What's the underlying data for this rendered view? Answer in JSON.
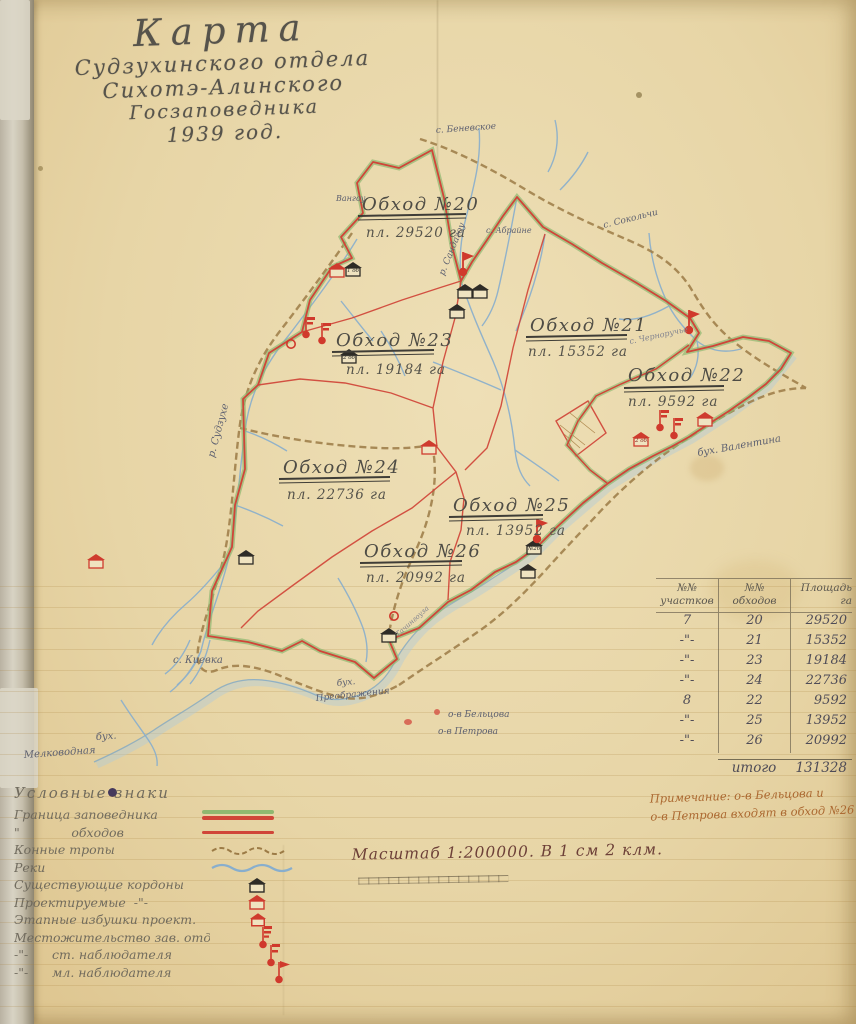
{
  "title": {
    "line1": "Карта",
    "line2": "Судзухинского отдела",
    "line3": "Сихотэ-Алинского",
    "line4": "Госзаповедника",
    "line5": "1939 год."
  },
  "map": {
    "obkhods": [
      {
        "name": "Обход №20",
        "area": "пл. 29520 га"
      },
      {
        "name": "Обход №21",
        "area": "пл. 15352 га"
      },
      {
        "name": "Обход №22",
        "area": "пл. 9592 га"
      },
      {
        "name": "Обход №23",
        "area": "пл. 19184 га"
      },
      {
        "name": "Обход №24",
        "area": "пл. 22736 га"
      },
      {
        "name": "Обход №25",
        "area": "пл. 13952 га"
      },
      {
        "name": "Обход №26",
        "area": "пл. 20992 га"
      }
    ],
    "places": {
      "benevskoe": "с. Беневское",
      "sokolchi": "с. Сокольчи",
      "chernoruchye": "с. Черноручье",
      "vangou": "Вангоу",
      "abrayne": "с. Абрайне",
      "sudzuhe": "р. Судзухе",
      "sandagou": "р. Сандагоу",
      "kievka": "с. Киевка",
      "preobrazheniya1": "бух.",
      "preobrazheniya2": "Преображения",
      "beltsova": "о-в Бельцова",
      "petrova": "о-в Петрова",
      "melkovodnaya1": "бух.",
      "melkovodnaya2": "Мелководная",
      "valentina": "бух. Валентина",
      "tachingouza": "Тачингоуза"
    },
    "house_labels": {
      "vangou": "1 об.",
      "kordon23": "2 об.",
      "coast26": "№26",
      "valentina": "2 об."
    }
  },
  "table": {
    "headers": [
      {
        "top": "№№",
        "bottom": "участков"
      },
      {
        "top": "№№",
        "bottom": "обходов"
      },
      {
        "top": "Площадь",
        "bottom": "га"
      }
    ],
    "rows": [
      [
        "7",
        "20",
        "29520"
      ],
      [
        "-\"-",
        "21",
        "15352"
      ],
      [
        "-\"-",
        "23",
        "19184"
      ],
      [
        "-\"-",
        "24",
        "22736"
      ],
      [
        "8",
        "22",
        "9592"
      ],
      [
        "-\"-",
        "25",
        "13952"
      ],
      [
        "-\"-",
        "26",
        "20992"
      ]
    ],
    "total_label": "итого",
    "total_value": "131328",
    "note_line1": "Примечание: о-в Бельцова и",
    "note_line2": "о-в Петрова входят в обход №26"
  },
  "legend": {
    "heading": "Условные знаки",
    "items": [
      {
        "label": "Граница заповедника"
      },
      {
        "label": "\"             обходов"
      },
      {
        "label": "Конные тропы"
      },
      {
        "label": "Реки"
      },
      {
        "label": "Существующие кордоны"
      },
      {
        "label": "Проектируемые  -\"-"
      },
      {
        "label": "Этапные избушки проект."
      },
      {
        "label": "Местожительство зав. отделом"
      },
      {
        "label": "-\"-      ст. наблюдателя"
      },
      {
        "label": "-\"-      мл. наблюдателя"
      }
    ]
  },
  "scale_text": "Масштаб 1:200000. В 1 см 2 клм.",
  "colors": {
    "boundary_red": "#d04538",
    "boundary_green": "#8fb870",
    "trail_brown": "#9c7b46",
    "river_blue": "#88aecd",
    "kordon_black": "#2e2c27",
    "projected_red": "#cf3b2e"
  }
}
